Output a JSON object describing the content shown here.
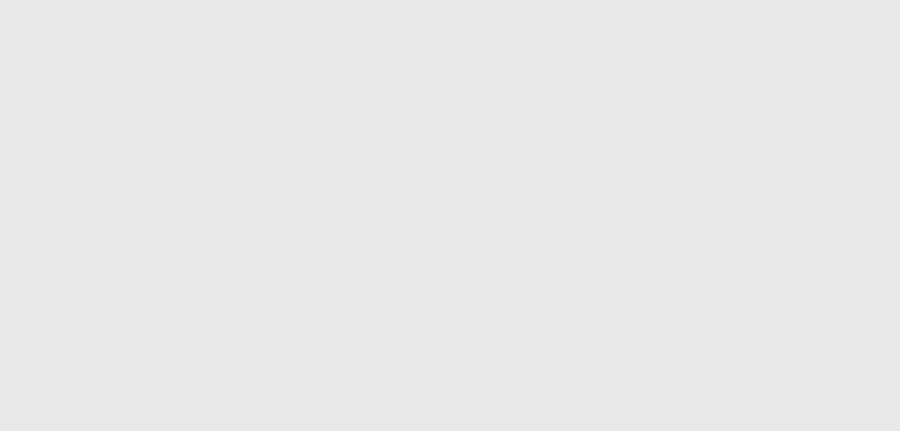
{
  "map": {
    "colors": {
      "background": "#e8e8e8",
      "parcel_line": "#4f4f4f",
      "thick_line": "#1d1d1d",
      "road_fill": "#ffffff",
      "road_edge": "#8f8f8f",
      "building_fill": "#e3a63d",
      "building_edge": "#7a4f12",
      "highlight_fill": "#b9c7e7",
      "highlight_edge": "#2da2dd",
      "text": "#151515",
      "guide_line": "#c2a855"
    },
    "highlight_parcel": {
      "points": "436,151 492,144 513,256 457,269",
      "number": "501",
      "sub_label": "421",
      "circle": {
        "x": 460,
        "y": 211,
        "rx": 11,
        "ry": 9
      }
    },
    "circled_labels": [
      {
        "text": "181",
        "x": 11,
        "y": 233,
        "rx": 10,
        "ry": 8
      },
      {
        "text": "19",
        "x": 22,
        "y": 366,
        "rx": 10,
        "ry": 8.5
      }
    ],
    "node_markers": [
      {
        "number": "7",
        "x": 803,
        "y": 222
      },
      {
        "number": "5",
        "x": 6,
        "y": 327
      }
    ],
    "roads": [
      {
        "name": "road-west-east",
        "points": "33,197 120,181 363,145 513,124 688,97",
        "width": 12,
        "cap": "round"
      },
      {
        "name": "road-north-south",
        "points": "704,-6 743,60 781,128 799,185 806,226",
        "width": 12,
        "cap": "butt"
      },
      {
        "name": "road-east-branch",
        "points": "806,226 858,236 904,244",
        "width": 10,
        "cap": "butt"
      },
      {
        "name": "road-south-branch",
        "points": "804,222 813,267 819,330 831,433",
        "width": 10,
        "cap": "butt"
      },
      {
        "name": "road-bottom",
        "points": "68,329 240,363 420,383 610,399 822,421",
        "width": 11,
        "cap": "round"
      }
    ],
    "parcel_lines": [
      "0,14 22,4 237,8",
      "22,4 28,52",
      "28,52 47,160",
      "237,8 253,130",
      "295,0 312,141",
      "561,13 670,0",
      "561,13 572,92",
      "670,0 686,56 575,95",
      "575,95 690,80",
      "770,112 900,58",
      "793,162 845,152 900,168",
      "660,133 692,172 699,192",
      "699,192 745,183 751,181",
      "751,181 755,254",
      "548,102 560,190 595,270 607,296",
      "607,296 660,277 733,268 806,244",
      "607,296 643,353 668,387 688,431",
      "703,258 757,254",
      "362,128 383,260 413,337 429,358",
      "247,190 260,257 250,333 244,358",
      "25,215 32,315 33,431",
      "57,225 45,340 42,431",
      "7,283 27,277 30,294 10,299 7,283",
      "237,383 227,431",
      "322,362 310,431"
    ],
    "tick_lines": [
      {
        "points": "28,52 237,8",
        "ticks": 10
      },
      {
        "points": "33,191 363,139 688,91",
        "ticks": 22
      },
      {
        "points": "47,160 253,130",
        "ticks": 8
      }
    ],
    "thick_lines": [
      "3,95 15,210",
      "1,215 2,248",
      "0,373 12,431"
    ],
    "dotted_lines": [
      "688,95 696,132",
      "797,153 804,218"
    ],
    "guide_line": "64,328 54,345 48,370 52,398 58,420 57,431",
    "buildings": [
      {
        "points": "552,6 593,0 601,36 560,43",
        "number": "3",
        "np": [
          575,
          20
        ],
        "code": "МЖ",
        "cp": [
          600,
          31
        ]
      },
      {
        "points": "616,0 652,0 649,13 618,11",
        "code": "МЖ",
        "cp": [
          661,
          7
        ]
      },
      {
        "points": "596,42 640,26 651,55 638,60 642,70 603,82",
        "number": "1",
        "np": [
          621,
          53
        ],
        "code": "МЖ",
        "cp": [
          646,
          42
        ]
      },
      {
        "points": "586,80 605,76 609,94 590,98",
        "number": "2",
        "np": [
          597,
          86
        ],
        "code": "ПЖ",
        "cp": [
          600,
          100
        ]
      },
      {
        "points": "731,19 757,12 767,47 746,53 743,41 734,44",
        "code": "МЖ",
        "cp": [
          751,
          31
        ]
      },
      {
        "points": "836,62 878,55 882,80 840,87",
        "number": "1",
        "np": [
          858,
          71
        ],
        "code": "ПЖ",
        "cp": [
          886,
          72
        ]
      },
      {
        "points": "696,127 719,122 725,158 704,163 701,148 694,150",
        "code": "МЖ",
        "cp": [
          710,
          141
        ]
      },
      {
        "points": "681,207 703,203 706,222 684,226",
        "number": "2",
        "np": [
          691,
          215
        ],
        "code": "ПЖ",
        "cp": [
          697,
          229
        ]
      },
      {
        "points": "700,197 742,190 747,238 733,240 735,252 716,254 714,243 703,244",
        "number": "1",
        "np": [
          721,
          221
        ]
      },
      {
        "points": "728,196 741,194 742,203 729,205",
        "code": "МЖ",
        "cp": [
          748,
          197
        ]
      },
      {
        "points": "729,212 743,210 745,226 731,228",
        "number": "2",
        "np": [
          736,
          219
        ],
        "code": "МЖ",
        "cp": [
          741,
          234
        ]
      },
      {
        "points": "866,213 902,194 902,292 876,280",
        "code": "МЖ",
        "cp": [
          892,
          213
        ]
      },
      {
        "points": "559,296 584,289 589,309 564,316",
        "number": "5",
        "np": [
          572,
          302
        ],
        "code": "ПС",
        "cp": [
          571,
          318
        ]
      },
      {
        "points": "596,294 612,291 615,305 599,308",
        "number": "4",
        "np": [
          604,
          299
        ],
        "code": "ПС",
        "cp": [
          605,
          312
        ]
      },
      {
        "points": "665,305 706,292 712,314 671,327",
        "number": "4",
        "np": [
          687,
          309
        ],
        "code": "ПС",
        "cp": [
          707,
          318
        ]
      },
      {
        "points": "584,347 626,341 629,357 587,363",
        "number": "2",
        "np": [
          604,
          351
        ],
        "code": "ПС",
        "cp": [
          626,
          359
        ]
      },
      {
        "points": "598,362 633,356 637,384 623,386 624,392 606,394 605,386 600,387",
        "number": "1",
        "np": [
          615,
          373
        ],
        "code": "МЖ",
        "cp": [
          636,
          374
        ]
      },
      {
        "points": "556,386 601,379 605,399 560,406",
        "number": "3",
        "np": [
          578,
          392
        ]
      },
      {
        "points": "714,336 730,333 733,354 717,357",
        "number": "1",
        "np": [
          722,
          345
        ]
      },
      {
        "points": "742,339 775,334 778,350 745,355",
        "code": "МС",
        "cp": [
          768,
          346
        ]
      },
      {
        "points": "337,340 392,332 395,349 340,357",
        "number": "1",
        "np": [
          366,
          344
        ],
        "code": "ПС",
        "cp": [
          399,
          343
        ]
      },
      {
        "points": "286,277 325,271 328,288 289,294",
        "number": "2",
        "np": [
          306,
          282
        ],
        "code": "ПЖ",
        "cp": [
          332,
          284
        ]
      },
      {
        "points": "296,292 327,288 330,304 299,308",
        "number": "1",
        "np": [
          313,
          297
        ],
        "code": "ПЖ",
        "cp": [
          334,
          301
        ]
      },
      {
        "points": "277,397 324,390 328,413 281,420",
        "number": "3",
        "np": [
          301,
          404
        ],
        "code": "ПЖ",
        "cp": [
          332,
          409
        ]
      },
      {
        "points": "341,396 392,389 396,420 380,422 381,428 360,430 359,423 345,424",
        "number": "1",
        "np": [
          368,
          408
        ],
        "code": "МЖ",
        "cp": [
          398,
          413
        ]
      },
      {
        "points": "352,388 367,386 368,395 353,397"
      }
    ],
    "labels": [
      {
        "text": "187",
        "x": 147,
        "y": 87,
        "s": 6
      },
      {
        "text": "108",
        "x": 281,
        "y": 71,
        "s": 5.5
      },
      {
        "text": "358",
        "x": 219,
        "y": 159,
        "s": 5
      },
      {
        "text": "356",
        "x": 514,
        "y": 121,
        "s": 5
      },
      {
        "text": "110",
        "x": 601,
        "y": 64,
        "s": 5
      },
      {
        "text": "114",
        "x": 806,
        "y": 11,
        "s": 5
      },
      {
        "text": "115",
        "x": 841,
        "y": 97,
        "s": 5
      },
      {
        "text": "196",
        "x": 871,
        "y": 236,
        "s": 5
      },
      {
        "text": "197",
        "x": 646,
        "y": 199,
        "s": 5
      },
      {
        "text": "197",
        "x": 618,
        "y": 283,
        "s": 5
      },
      {
        "text": "198",
        "x": 723,
        "y": 265,
        "s": 5
      },
      {
        "text": "202",
        "x": 160,
        "y": 233,
        "s": 5.5
      },
      {
        "text": "202",
        "x": 166,
        "y": 308,
        "s": 5.5
      },
      {
        "text": "203",
        "x": 225,
        "y": 422,
        "s": 5.5
      },
      {
        "text": "200",
        "x": 315,
        "y": 309,
        "s": 5
      },
      {
        "text": "201",
        "x": 330,
        "y": 350,
        "s": 5
      },
      {
        "text": "201",
        "x": 402,
        "y": 356,
        "s": 5
      },
      {
        "text": "267",
        "x": 240,
        "y": 367,
        "s": 5
      },
      {
        "text": "424",
        "x": 376,
        "y": 193,
        "s": 5
      },
      {
        "text": "434",
        "x": 386,
        "y": 277,
        "s": 5
      },
      {
        "text": "424",
        "x": 537,
        "y": 219,
        "s": 5
      },
      {
        "text": "424",
        "x": 530,
        "y": 341,
        "s": 5
      },
      {
        "text": "111",
        "x": 13,
        "y": 288,
        "s": 4
      },
      {
        "text": "133",
        "x": 6,
        "y": 306,
        "s": 4
      },
      {
        "text": "КМЕТСТВО",
        "x": 874,
        "y": 261,
        "s": 3.5
      }
    ]
  }
}
